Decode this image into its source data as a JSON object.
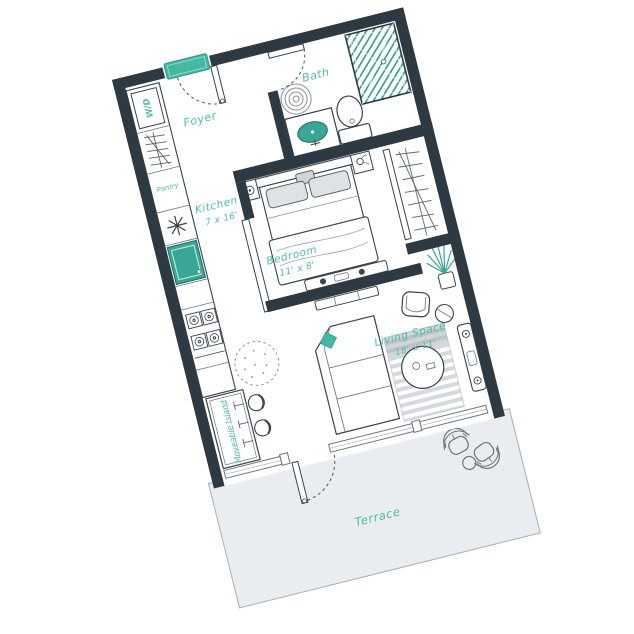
{
  "plan": {
    "rooms": {
      "foyer": {
        "label": "Foyer"
      },
      "bath": {
        "label": "Bath"
      },
      "pantry": {
        "label": "Pantry"
      },
      "kitchen": {
        "label": "Kitchen",
        "dims": "7 x 16'"
      },
      "bedroom": {
        "label": "Bedroom",
        "dims": "11' x 8'"
      },
      "living": {
        "label": "Living Space",
        "dims": "18' x 11'"
      },
      "terrace": {
        "label": "Terrace"
      }
    },
    "features": {
      "washer_dryer": {
        "label": "W/D"
      },
      "island": {
        "label": "Moveable Island"
      },
      "mat": {
        "label": "HELLO"
      }
    },
    "colors": {
      "wall": "#2d3a44",
      "accent": "#43b7a2",
      "accent_dark": "#2f9c8b",
      "label": "#4cbcab",
      "terrace_fill": "#eaedef",
      "outline": "#39434c"
    }
  }
}
